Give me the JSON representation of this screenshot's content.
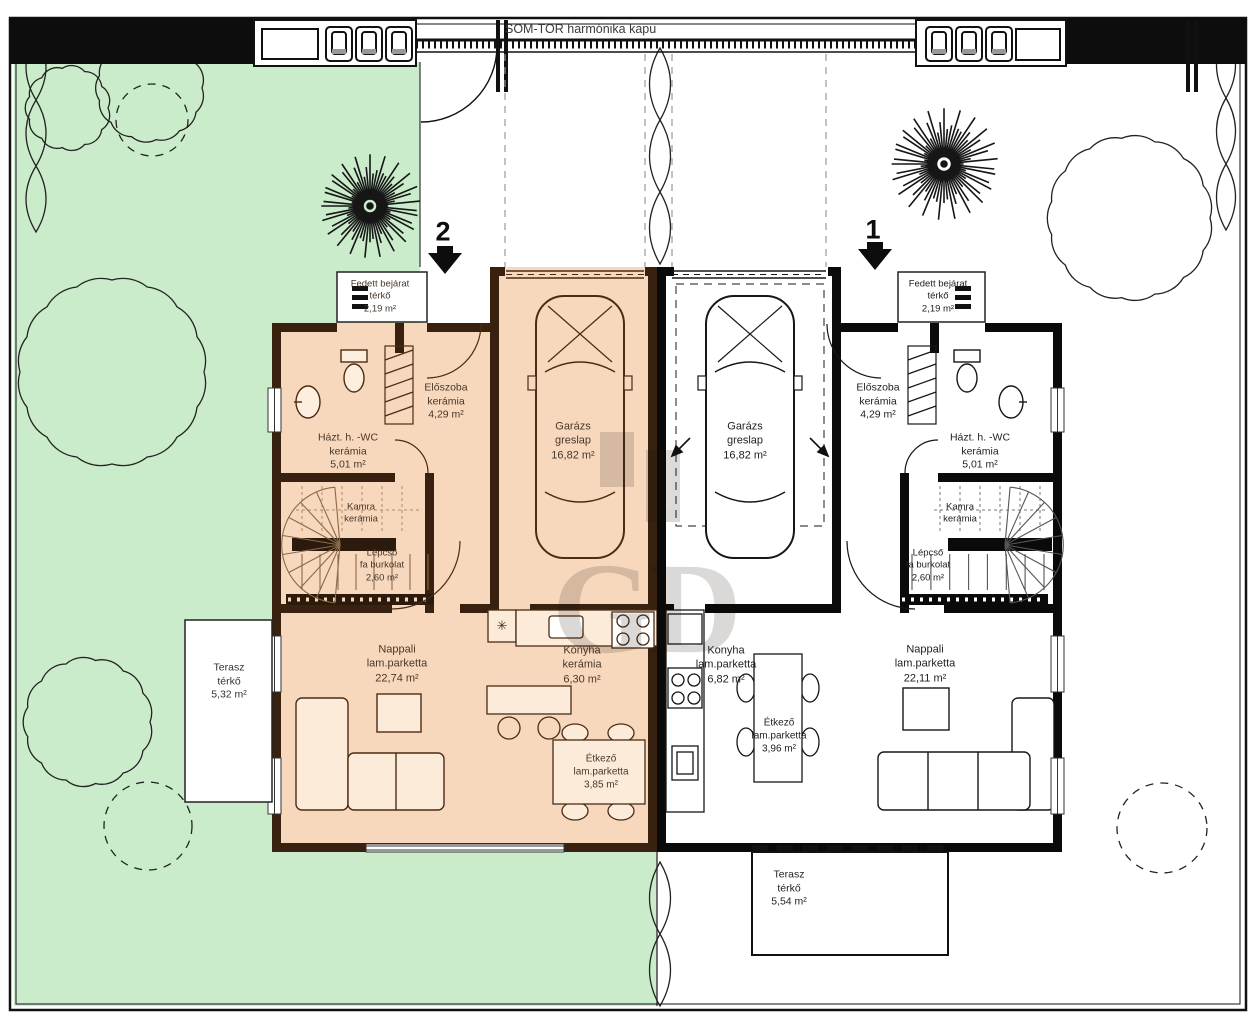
{
  "site": {
    "gate_label": "SOM-TOR harmónika kapu"
  },
  "watermark": {
    "g": "G",
    "d": "D"
  },
  "symbols": {
    "kitchen_star": "✳"
  },
  "colors": {
    "garden_green": "#cbeccb",
    "unit2_fill": "#f8d8bd",
    "unit2_wall": "#38220f",
    "unit1_fill": "#ffffff",
    "unit1_wall": "#0a0a0a"
  },
  "units": [
    {
      "id": "unit2",
      "number": "2",
      "rooms": {
        "entry": {
          "name": "Fedett bejárat",
          "material": "térkő",
          "area": "2,19 m²"
        },
        "wc": {
          "name": "Házt. h. -WC",
          "material": "kerámia",
          "area": "5,01 m²"
        },
        "eloszoba": {
          "name": "Előszoba",
          "material": "kerámia",
          "area": "4,29 m²"
        },
        "garazs": {
          "name": "Garázs",
          "material": "greslap",
          "area": "16,82 m²"
        },
        "kamra": {
          "name": "Kamra",
          "material": "kerámia",
          "area": ""
        },
        "lepcso": {
          "name": "Lépcső",
          "material": "fa burkolat",
          "area": "2,60 m²"
        },
        "nappali": {
          "name": "Nappali",
          "material": "lam.parketta",
          "area": "22,74 m²"
        },
        "konyha": {
          "name": "Konyha",
          "material": "kerámia",
          "area": "6,30 m²"
        },
        "etkezo": {
          "name": "Étkező",
          "material": "lam.parketta",
          "area": "3,85 m²"
        },
        "terasz": {
          "name": "Terasz",
          "material": "térkő",
          "area": "5,32 m²"
        }
      }
    },
    {
      "id": "unit1",
      "number": "1",
      "rooms": {
        "entry": {
          "name": "Fedett bejárat",
          "material": "térkő",
          "area": "2,19 m²"
        },
        "wc": {
          "name": "Házt. h. -WC",
          "material": "kerámia",
          "area": "5,01 m²"
        },
        "eloszoba": {
          "name": "Előszoba",
          "material": "kerámia",
          "area": "4,29 m²"
        },
        "garazs": {
          "name": "Garázs",
          "material": "greslap",
          "area": "16,82 m²"
        },
        "kamra": {
          "name": "Kamra",
          "material": "kerámia",
          "area": ""
        },
        "lepcso": {
          "name": "Lépcső",
          "material": "fa burkolat",
          "area": "2,60 m²"
        },
        "konyha": {
          "name": "Konyha",
          "material": "lam.parketta",
          "area": "6,82 m²"
        },
        "etkezo": {
          "name": "Étkező",
          "material": "lam.parketta",
          "area": "3,96 m²"
        },
        "nappali": {
          "name": "Nappali",
          "material": "lam.parketta",
          "area": "22,11 m²"
        },
        "terasz": {
          "name": "Terasz",
          "material": "térkő",
          "area": "5,54 m²"
        }
      }
    }
  ]
}
